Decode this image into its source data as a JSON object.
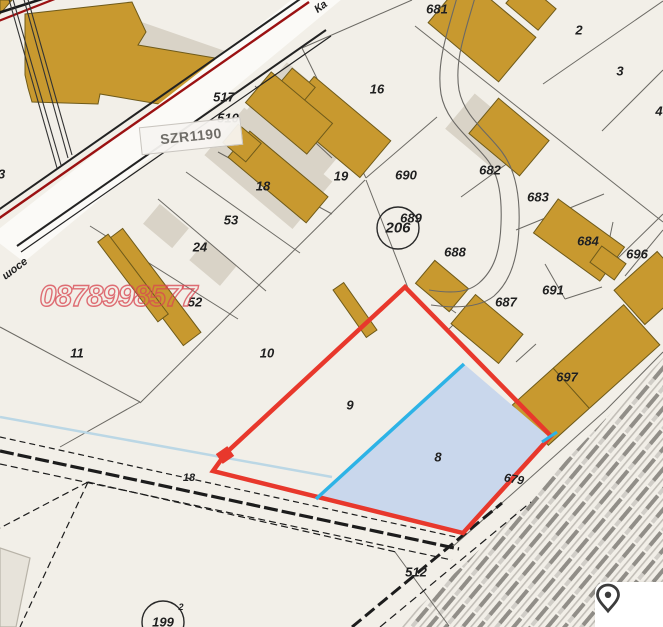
{
  "map": {
    "description": "cadastral-parcel-map",
    "labels": [
      {
        "text": "681",
        "x": 437,
        "y": 9
      },
      {
        "text": "2",
        "x": 579,
        "y": 30
      },
      {
        "text": "3",
        "x": 620,
        "y": 71
      },
      {
        "text": "4",
        "x": 659,
        "y": 111
      },
      {
        "text": "16",
        "x": 377,
        "y": 89
      },
      {
        "text": "517",
        "x": 224,
        "y": 97
      },
      {
        "text": "510",
        "x": 228,
        "y": 118
      },
      {
        "text": "18",
        "x": 263,
        "y": 186
      },
      {
        "text": "19",
        "x": 341,
        "y": 176
      },
      {
        "text": "690",
        "x": 406,
        "y": 175
      },
      {
        "text": "682",
        "x": 490,
        "y": 170
      },
      {
        "text": "683",
        "x": 538,
        "y": 197
      },
      {
        "text": "684",
        "x": 588,
        "y": 241
      },
      {
        "text": "696",
        "x": 637,
        "y": 254
      },
      {
        "text": "689",
        "x": 411,
        "y": 218
      },
      {
        "text": "206",
        "x": 398,
        "y": 228,
        "size": 15
      },
      {
        "text": "688",
        "x": 455,
        "y": 252
      },
      {
        "text": "691",
        "x": 553,
        "y": 290
      },
      {
        "text": "687",
        "x": 506,
        "y": 302
      },
      {
        "text": "697",
        "x": 567,
        "y": 377
      },
      {
        "text": "53",
        "x": 231,
        "y": 220
      },
      {
        "text": "24",
        "x": 200,
        "y": 247
      },
      {
        "text": "52",
        "x": 195,
        "y": 302
      },
      {
        "text": "33",
        "x": -2,
        "y": 174
      },
      {
        "text": "11",
        "x": 77,
        "y": 353
      },
      {
        "text": "10",
        "x": 267,
        "y": 353
      },
      {
        "text": "9",
        "x": 350,
        "y": 405
      },
      {
        "text": "8",
        "x": 438,
        "y": 457
      },
      {
        "text": "18",
        "x": 189,
        "y": 478,
        "size": 11
      },
      {
        "text": "679",
        "x": 514,
        "y": 479,
        "rot": 10,
        "size": 12
      },
      {
        "text": "512",
        "x": 416,
        "y": 572
      },
      {
        "text": "199",
        "x": 163,
        "y": 622
      },
      {
        "text": "2",
        "x": 181,
        "y": 607,
        "size": 9
      },
      {
        "text": "Ка",
        "x": 321,
        "y": 7,
        "rot": -37,
        "size": 11
      },
      {
        "text": "шосе",
        "x": 15,
        "y": 269,
        "rot": -37,
        "size": 11
      }
    ]
  },
  "watermark": {
    "text": "0878998577",
    "color": "#D84852"
  },
  "road_box": {
    "text": "SZR1190"
  },
  "colors": {
    "background": "#F2EFE8",
    "building": "#C8992F",
    "building_outline": "#6E5A1A",
    "shadow": "#D9D3C7",
    "parcel_line": "#55534E",
    "highlight_red": "#E8382C",
    "road_red": "#9B1112",
    "highlight_cyan": "#2DB3E6",
    "parcel8_fill": "#C9D7EC",
    "water_line": "#BBD7E5"
  },
  "pin_button": {
    "icon": "location-pin-icon"
  }
}
